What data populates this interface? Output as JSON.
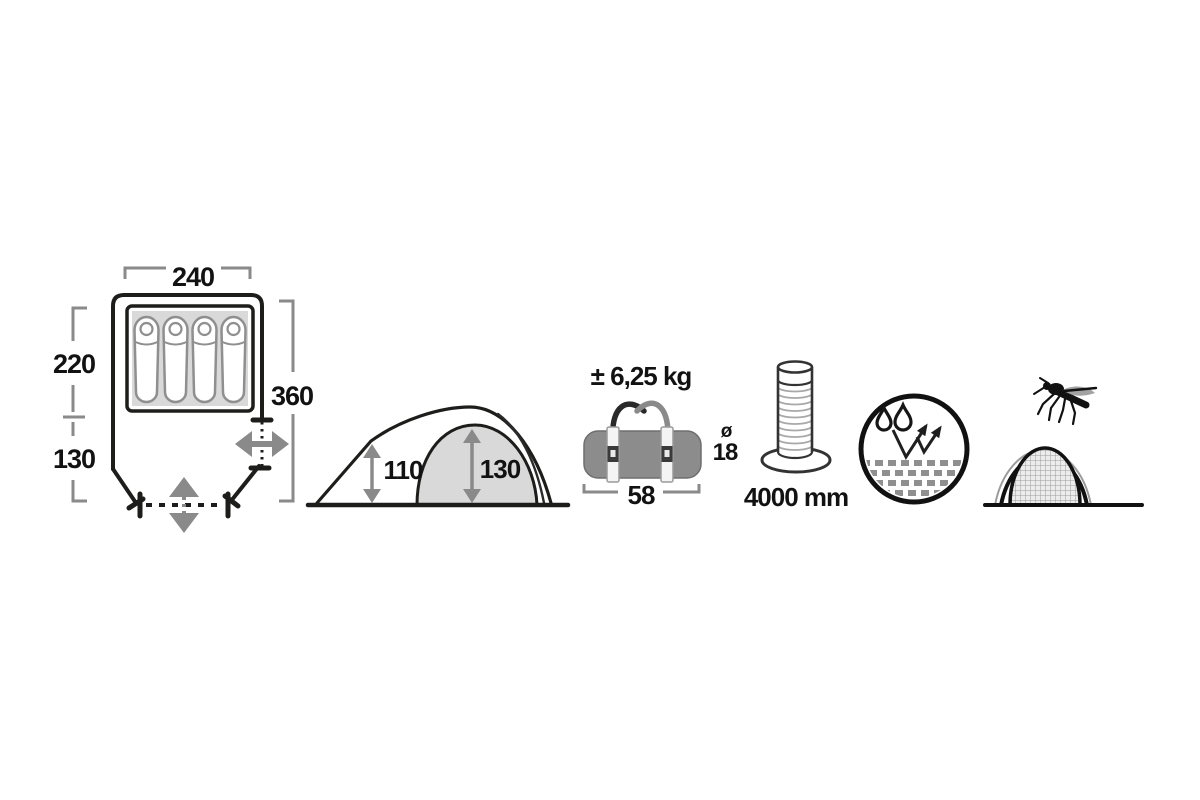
{
  "floor_plan": {
    "width_label": "240",
    "inner_length_label": "220",
    "vestibule_length_label": "130",
    "total_length_label": "360",
    "sleeping_capacity": 4
  },
  "side_view": {
    "vestibule_height_label": "110",
    "peak_height_label": "130"
  },
  "pack_size": {
    "weight_label": "± 6,25 kg",
    "diameter_symbol": "ø",
    "diameter_label": "18",
    "length_label": "58"
  },
  "water_column": {
    "value_label": "4000 mm"
  },
  "icons": {
    "floor_plan": "tent-floor-plan-icon",
    "side_view": "tent-side-view-icon",
    "pack_bag": "carry-bag-icon",
    "water_column": "water-column-icon",
    "waterproof": "water-repellent-icon",
    "mosquito_net": "mosquito-net-icon"
  },
  "colors": {
    "outline_black": "#1d1d1b",
    "dimension_gray": "#8a8a8a",
    "light_gray_fill": "#d9d9d9",
    "bag_gray_fill": "#8c8c8c",
    "background": "#ffffff"
  }
}
